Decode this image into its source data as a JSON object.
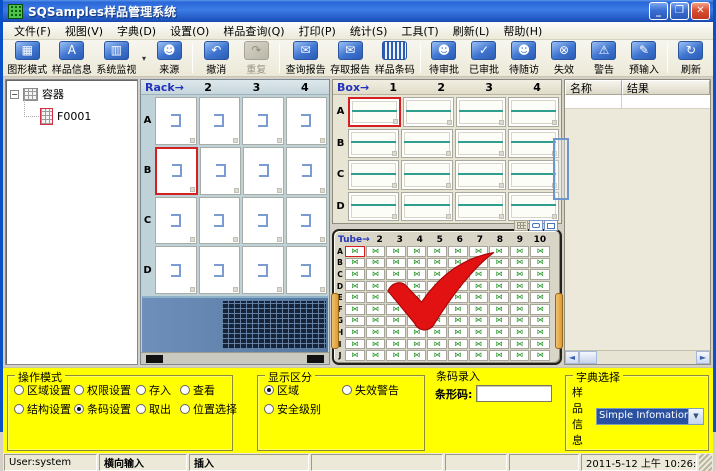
{
  "window": {
    "title": "SQSamples样品管理系统"
  },
  "menu": {
    "items": [
      "文件(F)",
      "视图(V)",
      "字典(D)",
      "设置(O)",
      "样品查询(Q)",
      "打印(P)",
      "统计(S)",
      "工具(T)",
      "刷新(L)",
      "帮助(H)"
    ]
  },
  "toolbar": {
    "items": [
      {
        "type": "button",
        "name": "graph-mode",
        "label": "图形模式",
        "glyph": "▦"
      },
      {
        "type": "button",
        "name": "sample-info",
        "label": "样品信息",
        "glyph": "A"
      },
      {
        "type": "button",
        "name": "system-monitor",
        "label": "系统监视",
        "glyph": "▥"
      },
      {
        "type": "dropdown",
        "name": "monitor-dropdown",
        "glyph": "▾"
      },
      {
        "type": "button",
        "name": "source",
        "label": "来源",
        "glyph": "☻"
      },
      {
        "type": "sep"
      },
      {
        "type": "button",
        "name": "undo",
        "label": "撤消",
        "glyph": "↶"
      },
      {
        "type": "button",
        "name": "redo",
        "label": "重复",
        "glyph": "↷",
        "disabled": true
      },
      {
        "type": "sep"
      },
      {
        "type": "button",
        "name": "query-report",
        "label": "查询报告",
        "glyph": "✉"
      },
      {
        "type": "button",
        "name": "access-report",
        "label": "存取报告",
        "glyph": "✉"
      },
      {
        "type": "button",
        "name": "sample-barcode",
        "label": "样品条码",
        "glyph": "",
        "style": "barcode"
      },
      {
        "type": "sep"
      },
      {
        "type": "button",
        "name": "pending-approval",
        "label": "待审批",
        "glyph": "☻"
      },
      {
        "type": "button",
        "name": "approved",
        "label": "已审批",
        "glyph": "✓"
      },
      {
        "type": "button",
        "name": "pending-followup",
        "label": "待随访",
        "glyph": "☻"
      },
      {
        "type": "button",
        "name": "expired",
        "label": "失效",
        "glyph": "⊗"
      },
      {
        "type": "button",
        "name": "warning",
        "label": "警告",
        "glyph": "⚠"
      },
      {
        "type": "button",
        "name": "pre-input",
        "label": "预输入",
        "glyph": "✎"
      },
      {
        "type": "sep"
      },
      {
        "type": "button",
        "name": "refresh",
        "label": "刷新",
        "glyph": "↻"
      }
    ]
  },
  "tree": {
    "root_label": "容器",
    "child_label": "F0001"
  },
  "rack": {
    "label": "Rack→",
    "col_headers": [
      "2",
      "3",
      "4"
    ],
    "rows": [
      "A",
      "B",
      "C",
      "D"
    ],
    "cols": 4,
    "selected": {
      "row": "B",
      "col": 1
    }
  },
  "box": {
    "label": "Box→",
    "col_headers": [
      "1",
      "2",
      "3",
      "4"
    ],
    "rows": [
      "A",
      "B",
      "C",
      "D"
    ],
    "cols": 4,
    "selected": {
      "row": "A",
      "col": 1
    }
  },
  "tube": {
    "label": "Tube→",
    "col_headers": [
      "2",
      "3",
      "4",
      "5",
      "6",
      "7",
      "8",
      "9",
      "10"
    ],
    "rows": [
      "A",
      "B",
      "C",
      "D",
      "E",
      "F",
      "G",
      "H",
      "I",
      "J"
    ],
    "cols": 10,
    "selected": {
      "row": "A",
      "col": 1
    },
    "cell_glyph": "⋈"
  },
  "results": {
    "columns": [
      "名称",
      "结果"
    ]
  },
  "panels": {
    "operation_mode": {
      "title": "操作模式",
      "options": [
        {
          "label": "区域设置",
          "checked": false
        },
        {
          "label": "权限设置",
          "checked": false
        },
        {
          "label": "存入",
          "checked": false
        },
        {
          "label": "查看",
          "checked": false
        },
        {
          "label": "结构设置",
          "checked": false
        },
        {
          "label": "条码设置",
          "checked": true
        },
        {
          "label": "取出",
          "checked": false
        },
        {
          "label": "位置选择",
          "checked": false
        }
      ]
    },
    "display": {
      "title": "显示区分",
      "options": [
        {
          "label": "区域",
          "checked": true
        },
        {
          "label": "失效警告",
          "checked": false
        },
        {
          "label": "安全级别",
          "checked": false
        }
      ]
    },
    "barcode": {
      "title": "条码录入",
      "field_label": "条形码:",
      "value": ""
    },
    "dict": {
      "title": "字典选择",
      "field_label": "样品信息",
      "value": "Simple Infomation"
    }
  },
  "statusbar": {
    "user": "User:system",
    "input_mode": "横向输入",
    "insert_mode": "插入",
    "datetime": "2011-5-12 上午 10:26:26"
  },
  "colors": {
    "selection_red": "#d42020",
    "tube_green": "#1f8f1f",
    "box_teal": "#2f9e8e",
    "panel_yellow": "#ffff00",
    "titlebar_blue": "#2a67d8"
  }
}
